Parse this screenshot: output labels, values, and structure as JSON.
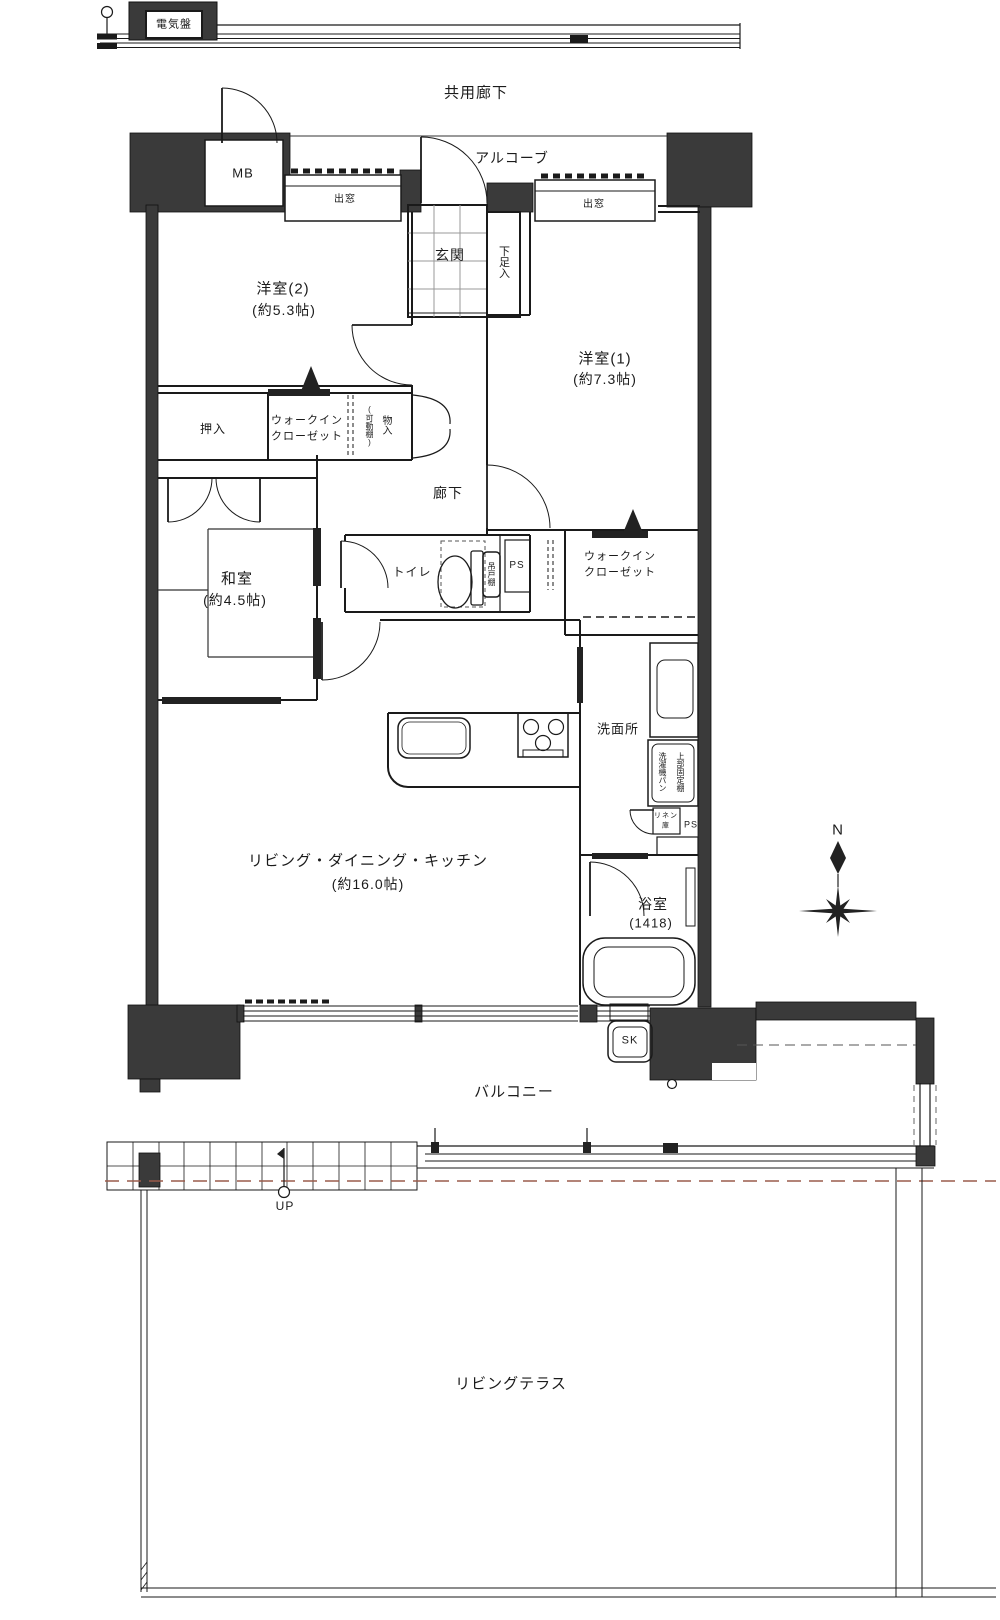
{
  "colors": {
    "wall": "#3a3a3a",
    "line": "#1a1a1a",
    "accent_dash": "#9a5b4b"
  },
  "labels": {
    "electrical_panel": "電気盤",
    "common_corridor": "共用廊下",
    "meter_box": "MB",
    "bay_window_1": "出窓",
    "bay_window_2": "出窓",
    "alcove": "アルコーブ",
    "entrance": "玄関",
    "shoe_cabinet": "下足入",
    "bedroom2_name": "洋室(2)",
    "bedroom2_size": "(約5.3帖)",
    "bedroom1_name": "洋室(1)",
    "bedroom1_size": "(約7.3帖)",
    "closet_oshiire": "押入",
    "wic1_line1": "ウォークイン",
    "wic1_line2": "クローゼット",
    "storage_note": "(可動棚)",
    "storage": "物入",
    "japanese_room_name": "和室",
    "japanese_room_size": "(約4.5帖)",
    "hallway": "廊下",
    "toilet": "トイレ",
    "hanging_shelf": "吊戸棚",
    "ps1": "PS",
    "wic2_line1": "ウォークイン",
    "wic2_line2": "クローゼット",
    "washroom": "洗面所",
    "laundry_pan": "洗濯機パン",
    "upper_shelf": "上部固定棚",
    "linen_line1": "リネン",
    "linen_line2": "庫",
    "ps2": "PS",
    "ldk_name": "リビング・ダイニング・キッチン",
    "ldk_size": "(約16.0帖)",
    "bath_name": "浴室",
    "bath_size": "(1418)",
    "slop_sink": "SK",
    "balcony": "バルコニー",
    "up": "UP",
    "living_terrace": "リビングテラス",
    "north": "N"
  }
}
